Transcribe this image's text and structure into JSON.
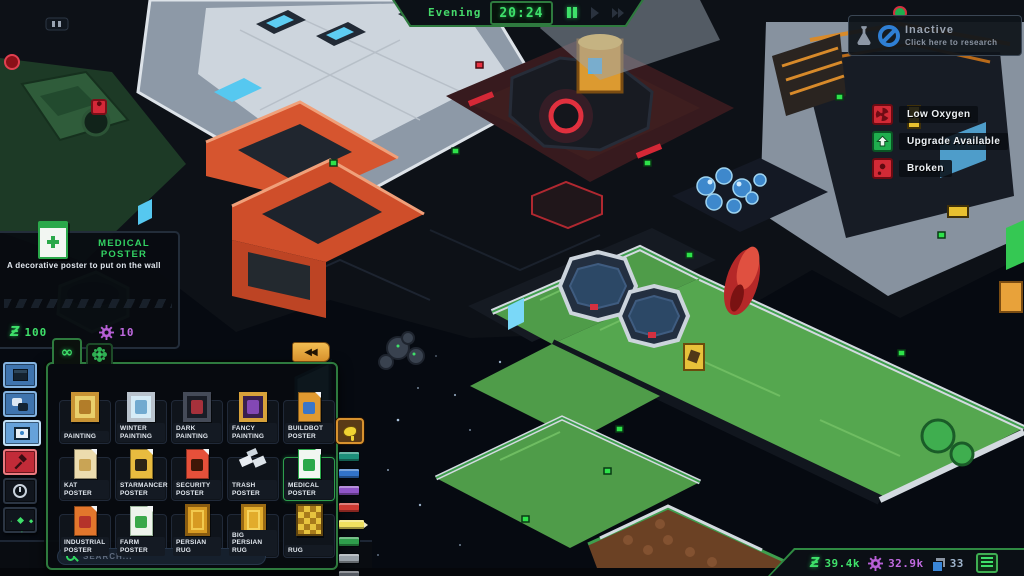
{
  "hud": {
    "time_bar": {
      "period": "Evening",
      "time": "20:24",
      "buttons": [
        {
          "icon": "pause-icon",
          "active": true
        },
        {
          "icon": "play-icon",
          "active": false
        },
        {
          "icon": "fast-forward-icon",
          "active": false
        },
        {
          "icon": "skip-icon",
          "active": false
        }
      ]
    },
    "research_button": {
      "title": "Inactive",
      "subtitle": "Click here to research",
      "icons": [
        "flask-icon",
        "disabled-icon"
      ]
    },
    "status_legend": [
      {
        "label": "Low Oxygen",
        "icon": "fan-icon",
        "color": "#d22a36"
      },
      {
        "label": "Upgrade Available",
        "icon": "upgrade-arrow-icon",
        "color": "#1fae4e"
      },
      {
        "label": "Broken",
        "icon": "wrench-icon",
        "color": "#d22a36"
      }
    ],
    "resources": [
      {
        "name": "credits",
        "icon": "credits-icon",
        "value": "39.4k",
        "color": "#3fe06a"
      },
      {
        "name": "gears",
        "icon": "gear-icon",
        "value": "32.9k",
        "color": "#c06ae0"
      },
      {
        "name": "cargo",
        "icon": "cargo-icon",
        "value": "33",
        "color": "#9fb4cc"
      }
    ],
    "menu_button": {
      "icon": "hamburger-icon"
    }
  },
  "tooltip": {
    "icon": "medical-poster-icon",
    "title": "MEDICAL POSTER",
    "description": "A decorative poster to put on the wall",
    "credits_cost": "100",
    "gears_cost": "10",
    "credits_icon": "credits-icon",
    "gears_icon": "gear-icon",
    "credits_glyph": "Ƶ"
  },
  "sidebar": [
    {
      "name": "structures",
      "icon": "window-icon",
      "style": "blue"
    },
    {
      "name": "crew",
      "icon": "chat-icon",
      "style": "blue"
    },
    {
      "name": "decorations",
      "icon": "picture-frame-icon",
      "style": "blue active",
      "active": true
    },
    {
      "name": "demolish",
      "icon": "hammer-icon",
      "style": "red"
    },
    {
      "name": "schedule",
      "icon": "clock-icon",
      "style": "dark"
    },
    {
      "name": "effects",
      "icon": "sparkles-icon",
      "style": "dark"
    }
  ],
  "build_menu": {
    "tabs": [
      {
        "icon": "infinity-icon",
        "glyph": "∞",
        "active": true
      },
      {
        "icon": "flower-icon",
        "active": false
      }
    ],
    "collapse_glyph": "◀◀",
    "search_placeholder": "SEARCH...",
    "items": [
      {
        "label": "PAINTING",
        "icon": "painting-icon",
        "type": "frame",
        "c1": "#c89334",
        "c2": "#e9cf6b",
        "c3": "#a86f1d"
      },
      {
        "label": "WINTER PAINTING",
        "icon": "winter-painting-icon",
        "type": "frame",
        "c1": "#b9c3cd",
        "c2": "#d6ecf7",
        "c3": "#5f9fc9"
      },
      {
        "label": "DARK PAINTING",
        "icon": "dark-painting-icon",
        "type": "frame",
        "c1": "#454b58",
        "c2": "#191d26",
        "c3": "#c03540"
      },
      {
        "label": "FANCY PAINTING",
        "icon": "fancy-painting-icon",
        "type": "frame",
        "c1": "#d8a23a",
        "c2": "#39204e",
        "c3": "#9050c8"
      },
      {
        "label": "BUILDBOT POSTER",
        "icon": "buildbot-poster-icon",
        "type": "poster",
        "c1": "#e09a30",
        "c2": "#3a76c8"
      },
      {
        "label": "KAT POSTER",
        "icon": "kat-poster-icon",
        "type": "poster",
        "c1": "#ecdcae",
        "c2": "#c9a455"
      },
      {
        "label": "STARMANCER POSTER",
        "icon": "starmancer-poster-icon",
        "type": "poster",
        "c1": "#e8bb3f",
        "c2": "#2c2416"
      },
      {
        "label": "SECURITY POSTER",
        "icon": "security-poster-icon",
        "type": "poster",
        "c1": "#e6503a",
        "c2": "#3f1707"
      },
      {
        "label": "TRASH POSTER",
        "icon": "trash-poster-icon",
        "type": "scatter",
        "c1": "#e9edf2"
      },
      {
        "label": "MEDICAL POSTER",
        "icon": "medical-poster-icon",
        "type": "poster",
        "c1": "#f1f6f1",
        "c2": "#2aa84a",
        "c3": "#2aa84a",
        "selected": true
      },
      {
        "label": "INDUSTRIAL POSTER",
        "icon": "industrial-poster-icon",
        "type": "poster",
        "c1": "#e2762c",
        "c2": "#b5332a"
      },
      {
        "label": "FARM POSTER",
        "icon": "farm-poster-icon",
        "type": "poster",
        "c1": "#eef4ec",
        "c2": "#3aa84a",
        "c3": "#9ab59a"
      },
      {
        "label": "PERSIAN RUG",
        "icon": "persian-rug-icon",
        "type": "rug",
        "c1": "#8a5c10",
        "c2": "#d79a22",
        "c3": "#f2c94e"
      },
      {
        "label": "BIG PERSIAN RUG",
        "icon": "big-persian-rug-icon",
        "type": "rug",
        "c1": "#9a6a14",
        "c2": "#e2ac2c",
        "c3": "#f6d45e"
      },
      {
        "label": "RUG",
        "icon": "rug-icon",
        "type": "check",
        "c1": "#e7c33e",
        "c2": "#a87b1b"
      }
    ]
  },
  "palette": {
    "tool_icon": "paint-blob-icon",
    "swatches": [
      {
        "name": "teal",
        "color": "#1d8f7a"
      },
      {
        "name": "blue",
        "color": "#3273c8"
      },
      {
        "name": "purple",
        "color": "#8f55c8"
      },
      {
        "name": "red",
        "color": "#cc3a32"
      },
      {
        "name": "yellow",
        "color": "#efe160",
        "selected": true
      },
      {
        "name": "green",
        "color": "#2f9e4c"
      },
      {
        "name": "light-gray",
        "color": "#98a0a8"
      },
      {
        "name": "dark-gray",
        "color": "#555a62"
      }
    ]
  }
}
